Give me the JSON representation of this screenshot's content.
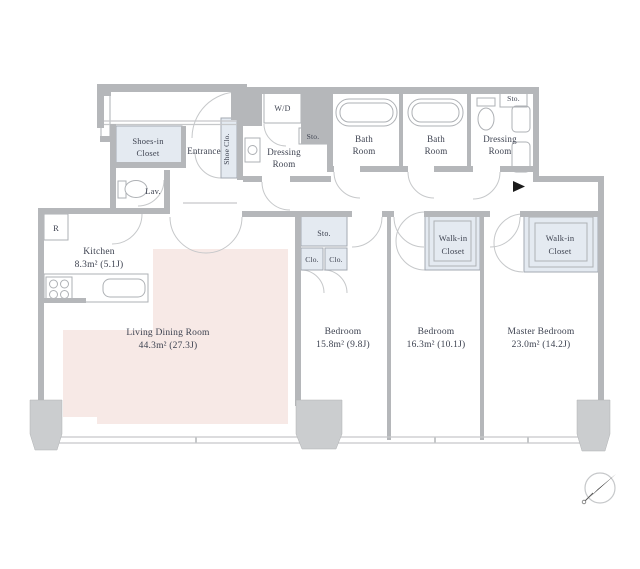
{
  "floor_plan": {
    "living_dining_room": {
      "name": "Living Dining Room",
      "area": "44.3m²  (27.3J)"
    },
    "kitchen": {
      "name": "Kitchen",
      "area": "8.3m²  (5.1J)"
    },
    "bedroom_1": {
      "name": "Bedroom",
      "area": "15.8m²  (9.8J)"
    },
    "bedroom_2": {
      "name": "Bedroom",
      "area": "16.3m²  (10.1J)"
    },
    "master_bedroom": {
      "name": "Master Bedroom",
      "area": "23.0m²  (14.2J)"
    },
    "entrance": {
      "name": "Entrance"
    },
    "shoes_in_closet": {
      "line1": "Shoes-in",
      "line2": "Closet"
    },
    "shoe_closet": {
      "name": "Shoe Clo."
    },
    "washer_dryer": {
      "name": "W/D"
    },
    "storage_hall": {
      "name": "Sto."
    },
    "dressing_room_1": {
      "line1": "Dressing",
      "line2": "Room"
    },
    "bath_room_1": {
      "line1": "Bath",
      "line2": "Room"
    },
    "bath_room_2": {
      "line1": "Bath",
      "line2": "Room"
    },
    "dressing_room_2": {
      "line1": "Dressing",
      "line2": "Room"
    },
    "storage_top_right": {
      "name": "Sto."
    },
    "lavatory": {
      "name": "Lav."
    },
    "refrigerator": {
      "name": "R"
    },
    "storage_bedroom_1": {
      "name": "Sto."
    },
    "closet_1": {
      "name": "Clo."
    },
    "closet_2": {
      "name": "Clo."
    },
    "walk_in_closet_1": {
      "line1": "Walk-in",
      "line2": "Closet"
    },
    "walk_in_closet_2": {
      "line1": "Walk-in",
      "line2": "Closet"
    }
  },
  "colors": {
    "wall": "#b5b7ba",
    "closet_fill": "#e4eaf1",
    "living_fill": "#f7e9e6",
    "column": "#cbcdcf",
    "text": "#3d4250",
    "line": "#c6c8ca",
    "fixture": "#aeb1b5"
  }
}
